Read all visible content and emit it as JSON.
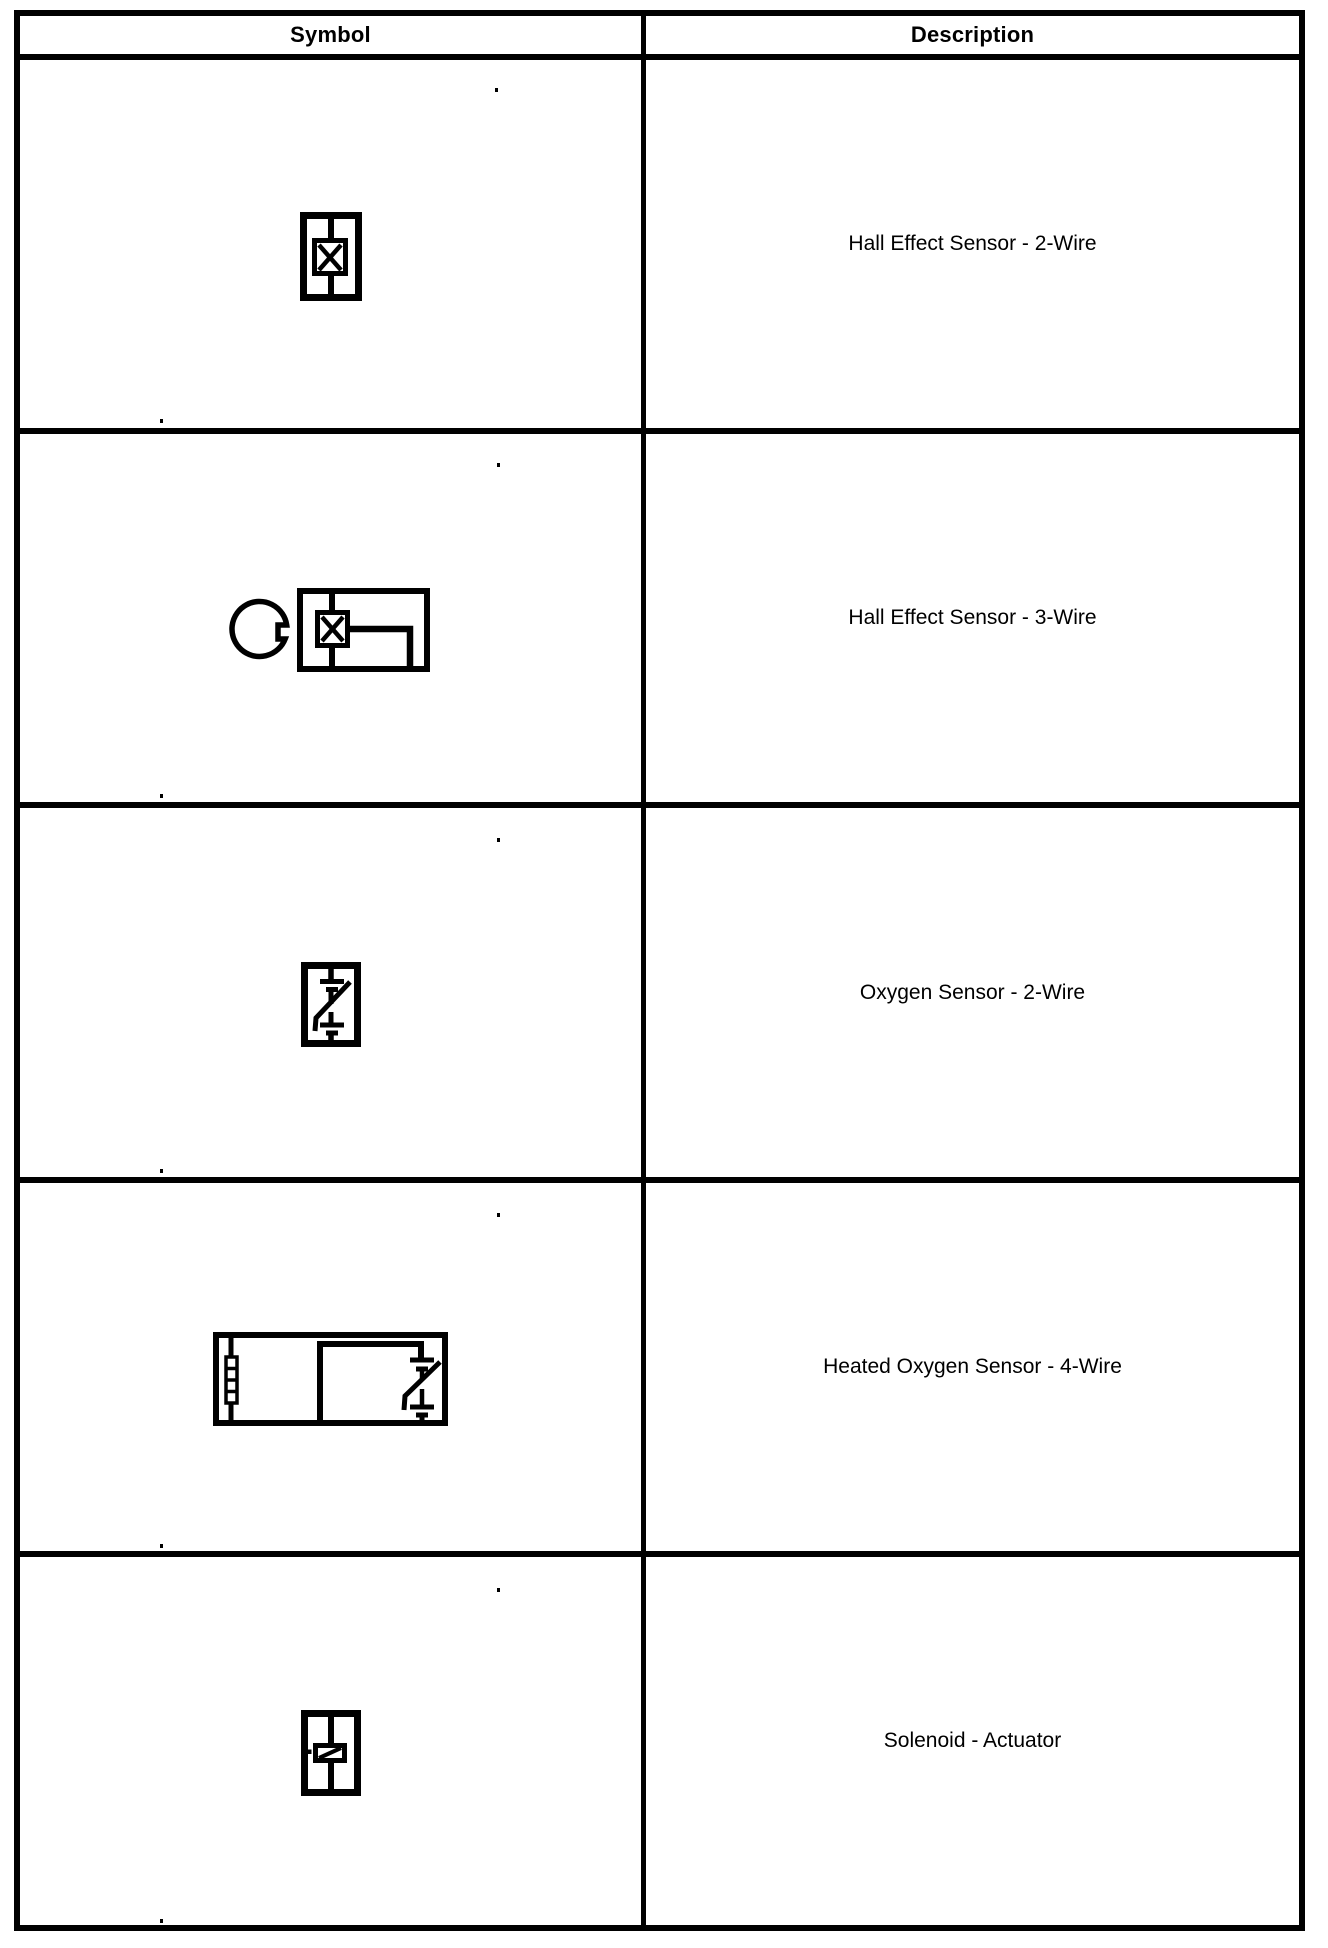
{
  "table": {
    "header": {
      "symbol_label": "Symbol",
      "description_label": "Description"
    },
    "rows": [
      {
        "symbol_icon": "hall-effect-sensor-2-wire-symbol",
        "description": "Hall Effect Sensor - 2-Wire"
      },
      {
        "symbol_icon": "hall-effect-sensor-3-wire-symbol",
        "description": "Hall Effect Sensor - 3-Wire"
      },
      {
        "symbol_icon": "oxygen-sensor-2-wire-symbol",
        "description": "Oxygen Sensor - 2-Wire"
      },
      {
        "symbol_icon": "heated-oxygen-sensor-4-wire-symbol",
        "description": "Heated Oxygen Sensor - 4-Wire"
      },
      {
        "symbol_icon": "solenoid-actuator-symbol",
        "description": "Solenoid - Actuator"
      }
    ],
    "colors": {
      "border": "#000000",
      "background": "#ffffff",
      "text": "#000000"
    }
  }
}
